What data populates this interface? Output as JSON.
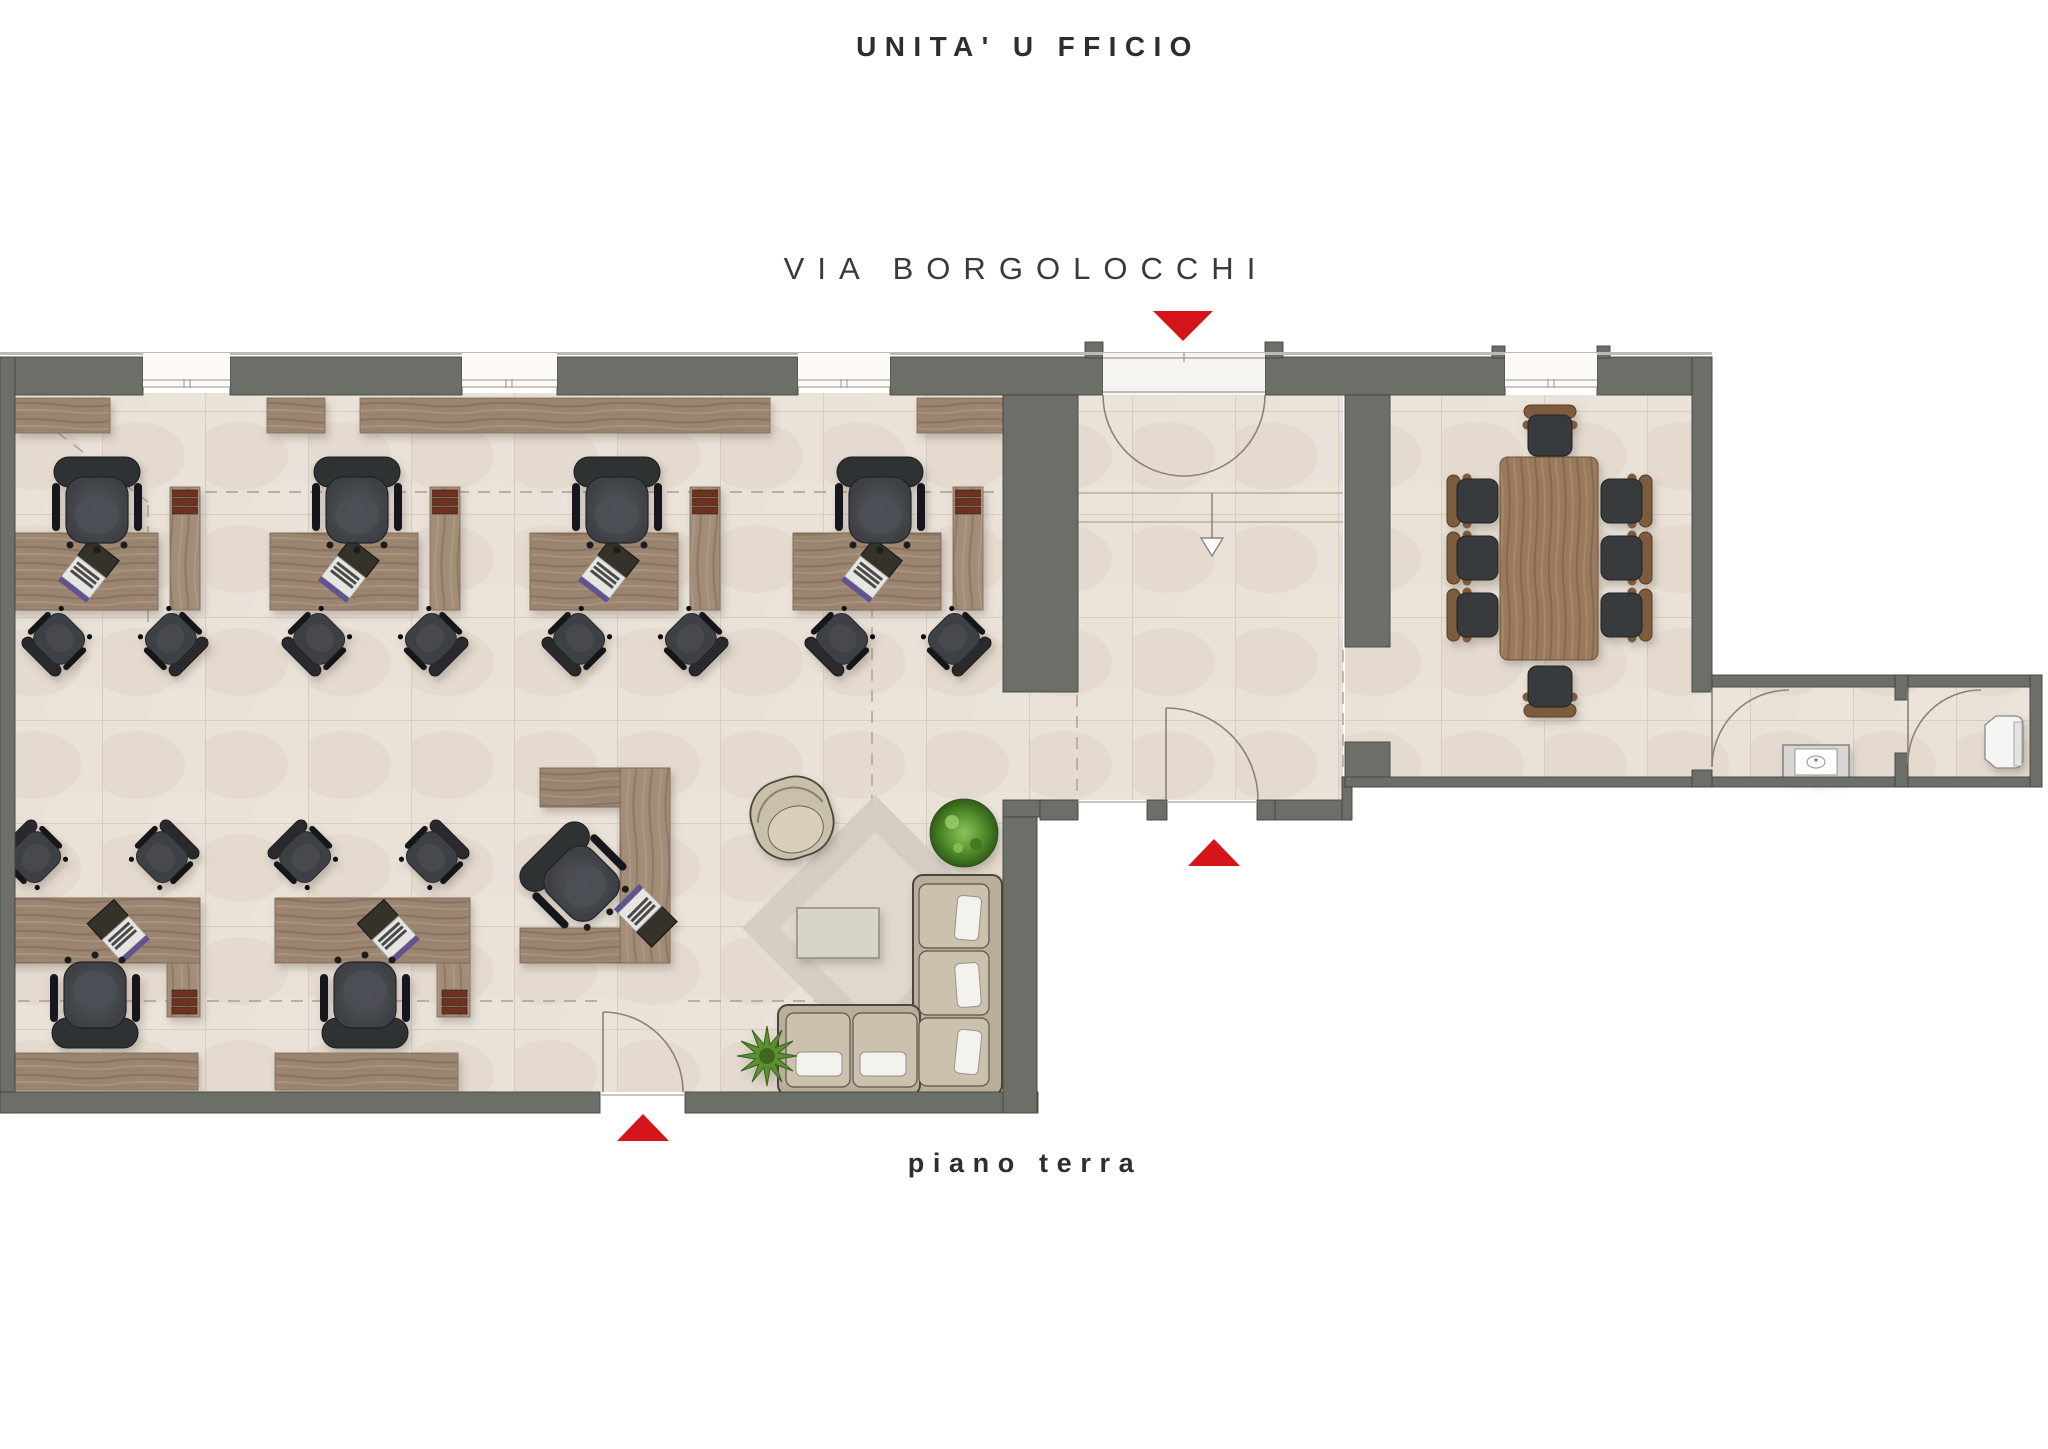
{
  "title": "UNITA' U FFICIO",
  "street_label": "VIA BORGOLOCCHI",
  "floor_label": "piano terra",
  "markers": {
    "street_entrance": "red-triangle-down-icon",
    "hall_rear_exit": "red-triangle-up-icon",
    "office_side_exit": "red-triangle-up-icon"
  },
  "colors": {
    "wall": "#6c6f68",
    "wall_edge": "#41443e",
    "floor": "#eae2d8",
    "street_line": "#bdb8b0",
    "wood": "#9c8672",
    "accent_red": "#d6151b",
    "dash": "#a89f92",
    "arc": "#8a8278"
  }
}
